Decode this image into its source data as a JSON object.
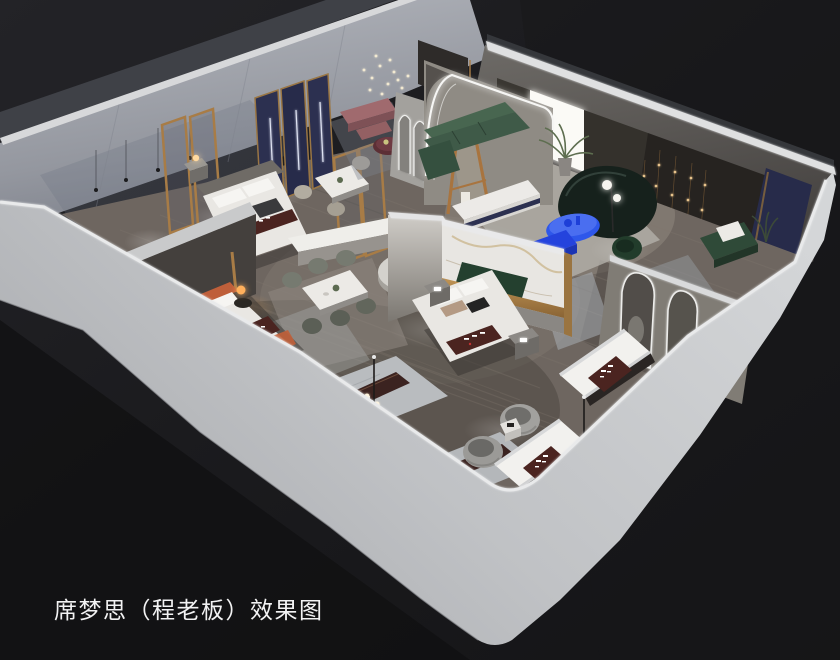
{
  "caption": {
    "text": "席梦思（程老板）效果图"
  },
  "scene": {
    "type": "3d-interior-rendering",
    "view": "isometric-birdseye-cutaway",
    "subject": "mattress-showroom-floorplan"
  },
  "colors": {
    "caption-color": "#f2f2f3",
    "background": "#1a1a1c",
    "wall-light": "#c9cbce",
    "wall-mid": "#a9abb0",
    "floor-wood": "#6e6660",
    "accent-blue": "#2e57ea",
    "accent-navy": "#2c3050",
    "sofa-green": "#3f5a48",
    "sofa-teal": "#16211c",
    "accent-terracotta": "#bf5f3a",
    "accent-mauve": "#a06a6e",
    "runner-brown": "#4b2420",
    "gold-trim": "#a87c46",
    "led-white": "#f4f4f2",
    "lamp-warm": "#ffb05c"
  }
}
